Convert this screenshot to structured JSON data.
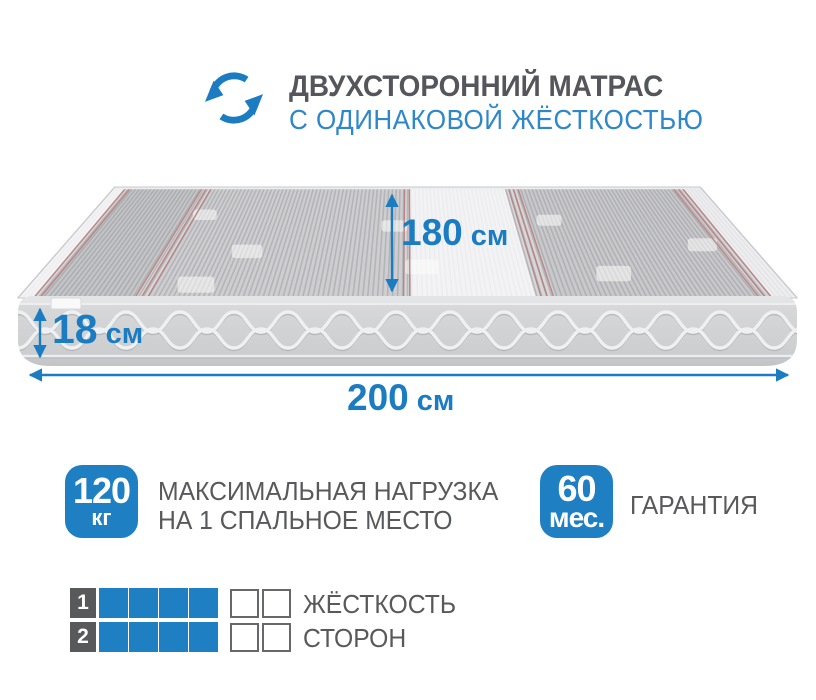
{
  "colors": {
    "accent_blue": "#1b7cc2",
    "subtitle_blue": "#2e87c9",
    "badge_blue": "#1e7fc3",
    "text_gray": "#58595b",
    "mattress_gray": "#d2d3d5",
    "red_pinstripe": "#b67d7d"
  },
  "header": {
    "icon": "rotate-icon",
    "title": "ДВУХСТОРОННИЙ МАТРАС",
    "subtitle": "С ОДИНАКОВОЙ ЖЁСТКОСТЬЮ"
  },
  "dimensions": {
    "depth": {
      "value": "180",
      "unit": "см"
    },
    "height": {
      "value": "18",
      "unit": "см"
    },
    "length": {
      "value": "200",
      "unit": "см"
    }
  },
  "features": [
    {
      "value": "120",
      "unit": "кг",
      "lines": [
        "МАКСИМАЛЬНАЯ НАГРУЗКА",
        "НА 1 СПАЛЬНОЕ МЕСТО"
      ]
    },
    {
      "value": "60",
      "unit": "мес.",
      "lines": [
        "ГАРАНТИЯ"
      ]
    }
  ],
  "firmness": {
    "label_top": "ЖЁСТКОСТЬ",
    "label_bottom": "СТОРОН",
    "scale_max": 6,
    "rows": [
      {
        "side": "1",
        "filled": 4
      },
      {
        "side": "2",
        "filled": 4
      }
    ]
  }
}
